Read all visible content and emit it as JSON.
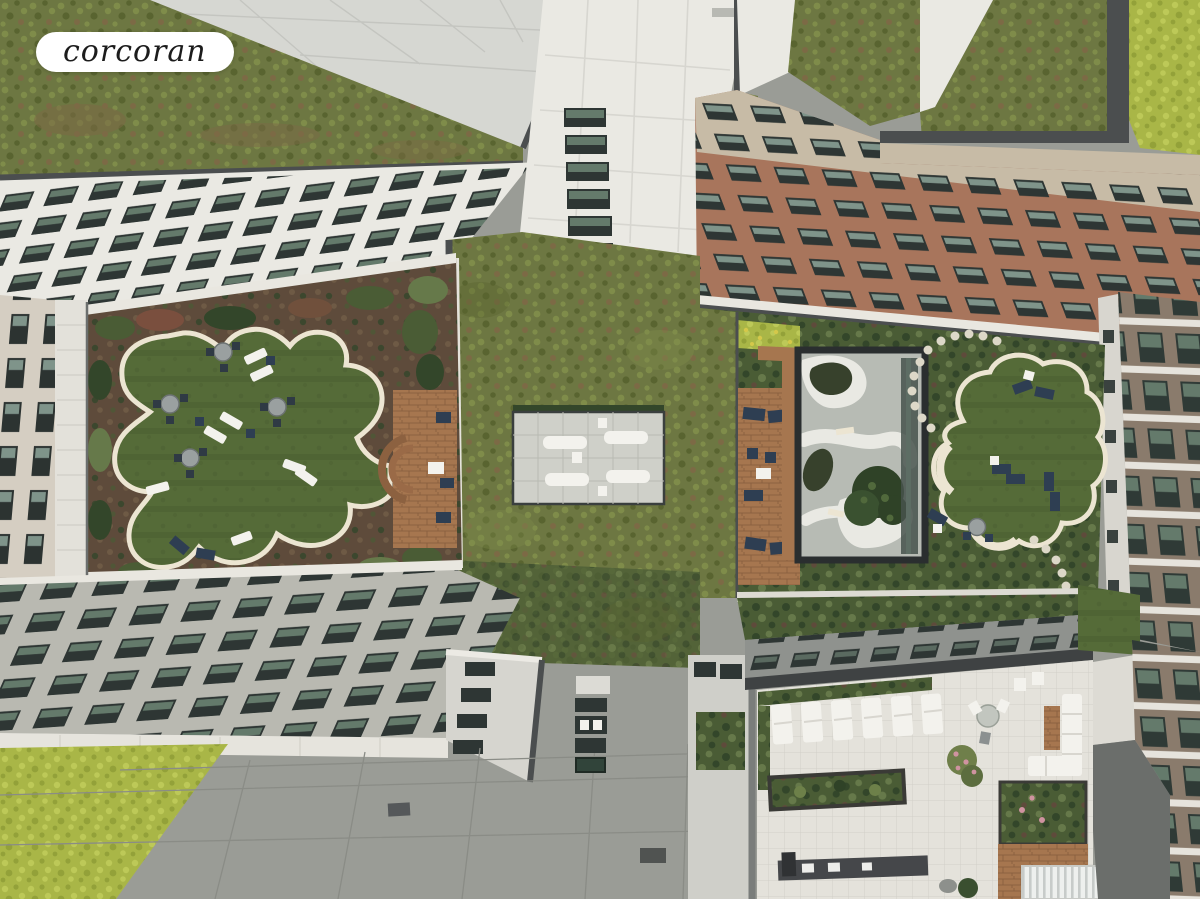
{
  "branding": {
    "logo_text": "corcoran"
  },
  "scene": {
    "alt": "Aerial drone view looking straight down at a residential complex with rooftop courtyards, sedum green roofs, sun decks and terraces",
    "regions": {
      "top_left_building": "White apartment tower facade (north-west)",
      "center_tower": "Central white tower facade with window column",
      "top_right_building": "Brick apartment tower facade (north-east)",
      "left_building": "West wing facade",
      "right_building": "East brick building side facade",
      "bottom_left_building": "South-west apartment facade",
      "center_green_roof": "Central sedum green roof",
      "sun_deck": "Paved sun deck with four lounge chairs",
      "west_courtyard": "West courtyard with lawn, cafe tables and wood deck",
      "east_courtyard": "East courtyard with clover lawn and stepping stones",
      "zen_garden": "Zen garden under glass skylight",
      "rooftop_terrace": "South-east rooftop terrace with loungers, planter and barbecue",
      "paved_roof": "Grey paved roof deck",
      "green_roof_corner": "Bright sedum green roof patch",
      "logo": "Corcoran logo badge"
    }
  },
  "palette": {
    "badge_bg": "#ffffff",
    "badge_text": "#1c1c1c",
    "paving_gray": "#9a9c96",
    "paving_light": "#d6d7d2",
    "seam_gray": "#8a8c86",
    "facade_white": "#eae9e3",
    "panel_line": "#d7d6d0",
    "parapet_dark": "#4b4e4f",
    "parapet_white": "#e9e7e0",
    "window_dark": "#2e3634",
    "glass_green": "#647a6b",
    "glass_light": "#7f948a",
    "brick_red": "#a8755c",
    "brick_beige": "#c7bba6",
    "brick_brown": "#8a7b6c",
    "sill_white": "#e6e3dc",
    "sedum_base": "#6d7742",
    "sedum_light": "#7f8c4a",
    "sedum_dark": "#596430",
    "sedum_brown": "#7c6a45",
    "sedum_bright": "#a9b647",
    "sedum_bright_light": "#bdc958",
    "sedum_bright_dark": "#93a139",
    "lawn_green": "#556b38",
    "lawn_dark": "#4b5f31",
    "cream_edge": "#ece5d2",
    "mulch_brown": "#5e4b3b",
    "mulch_light": "#6e5a45",
    "shrub_dark": "#33462a",
    "shrub_mid": "#4a5c35",
    "shrub_light": "#66794a",
    "wood_deck": "#a6764f",
    "wood_dark": "#8c6140",
    "navy": "#2e3e52",
    "furniture_white": "#f3f2ed",
    "zen_gray": "#b7bbb4",
    "zen_white": "#e9e9e3",
    "zen_bed": "#37412c",
    "terrace_white": "#e4e2db",
    "terrace_seam": "#d2d0c8",
    "roof_dark": "#6b6e6b",
    "stone_dot": "#ddd8c8",
    "flower_pink": "#cf93a0",
    "flower_yellow": "#d4c84a"
  }
}
